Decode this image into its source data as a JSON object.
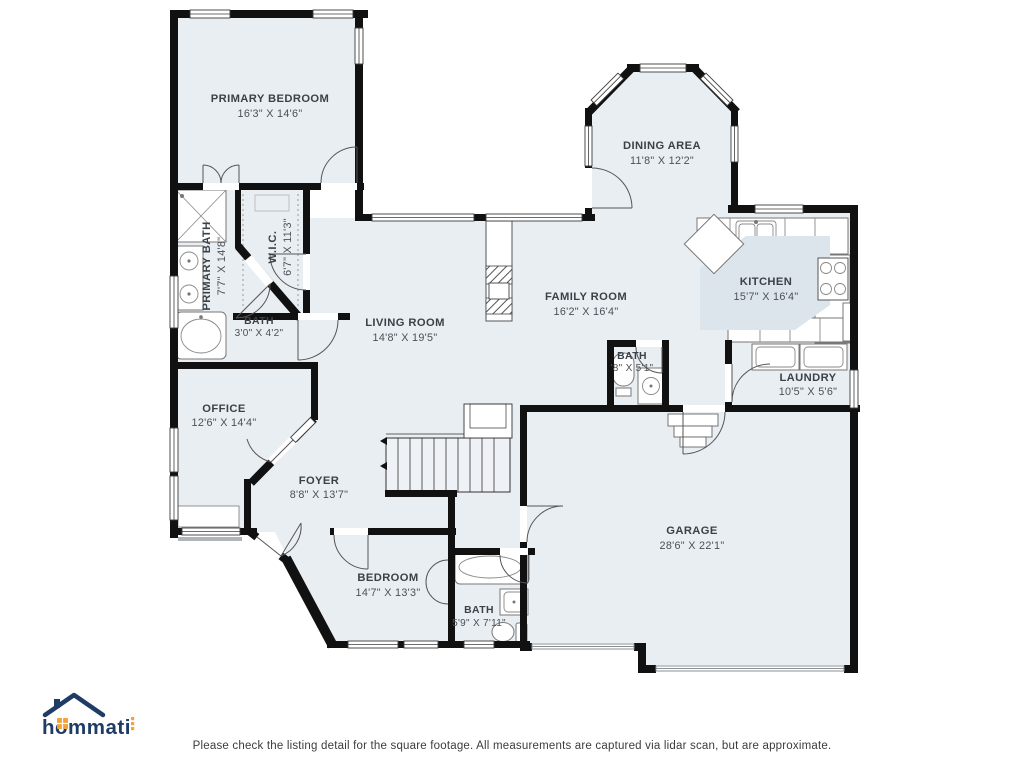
{
  "branding": {
    "logo_text": "hommati"
  },
  "footer": {
    "disclaimer": "Please check the listing detail for the square footage. All measurements are captured via lidar scan, but are approximate."
  },
  "colors": {
    "floor": "#e9eef3",
    "wall": "#111111",
    "label": "#3a4147",
    "logo_navy": "#1e3c64",
    "logo_orange": "#f2a33c"
  },
  "rooms": {
    "primary_bedroom": {
      "name": "PRIMARY BEDROOM",
      "dims": "16'3\" X 14'6\""
    },
    "primary_bath": {
      "name": "PRIMARY BATH",
      "dims": "7'7\" X 14'8\""
    },
    "wic": {
      "name": "W.I.C.",
      "dims": "6'7\" X 11'3\""
    },
    "bath_small": {
      "name": "BATH",
      "dims": "3'0\" X 4'2\""
    },
    "living_room": {
      "name": "LIVING ROOM",
      "dims": "14'8\" X 19'5\""
    },
    "dining_area": {
      "name": "DINING AREA",
      "dims": "11'8\" X 12'2\""
    },
    "family_room": {
      "name": "FAMILY ROOM",
      "dims": "16'2\" X 16'4\""
    },
    "kitchen": {
      "name": "KITCHEN",
      "dims": "15'7\" X 16'4\""
    },
    "bath_mid": {
      "name": "BATH",
      "dims": "'8\" X 5'1\""
    },
    "laundry": {
      "name": "LAUNDRY",
      "dims": "10'5\" X 5'6\""
    },
    "office": {
      "name": "OFFICE",
      "dims": "12'6\" X 14'4\""
    },
    "foyer": {
      "name": "FOYER",
      "dims": "8'8\" X 13'7\""
    },
    "bedroom": {
      "name": "BEDROOM",
      "dims": "14'7\" X 13'3\""
    },
    "bath_lower": {
      "name": "BATH",
      "dims": "5'9\" X 7'11\""
    },
    "garage": {
      "name": "GARAGE",
      "dims": "28'6\" X 22'1\""
    }
  }
}
